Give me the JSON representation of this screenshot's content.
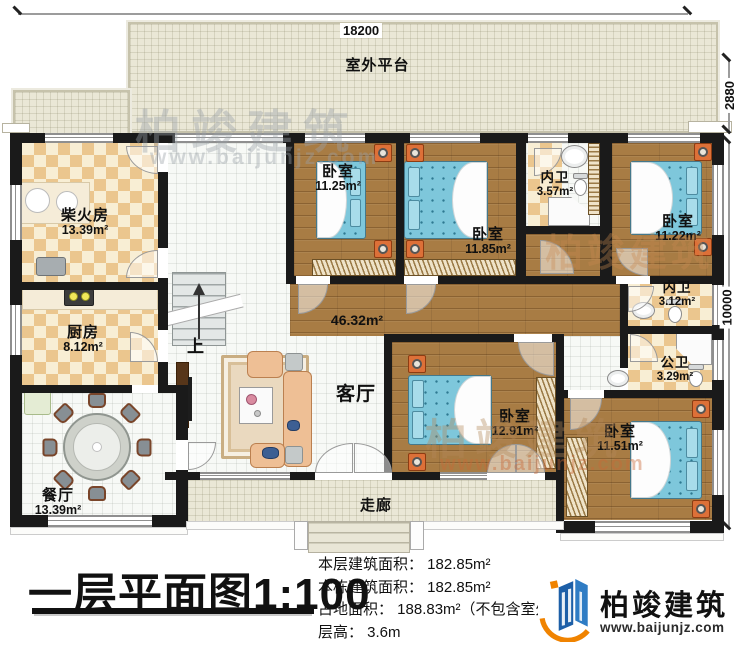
{
  "dimensions": {
    "top_width": "18200",
    "platform_depth": "2880",
    "side_depth": "10000"
  },
  "rooms": {
    "outdoor": {
      "name": "室外平台"
    },
    "chaihuofang": {
      "name": "柴火房",
      "area": "13.39m²"
    },
    "kitchen": {
      "name": "厨房",
      "area": "8.12m²"
    },
    "dining": {
      "name": "餐厅",
      "area": "13.39m²"
    },
    "living": {
      "name": "客厅",
      "area": "46.32m²"
    },
    "bedroom_a": {
      "name": "卧室",
      "area": "11.25m²"
    },
    "bedroom_b": {
      "name": "卧室",
      "area": "11.85m²"
    },
    "bedroom_c": {
      "name": "卧室",
      "area": "11.22m²"
    },
    "bedroom_d": {
      "name": "卧室",
      "area": "12.91m²"
    },
    "bedroom_e": {
      "name": "卧室",
      "area": "11.51m²"
    },
    "ensuite_a": {
      "name": "内卫",
      "area": "3.57m²"
    },
    "ensuite_b": {
      "name": "内卫",
      "area": "3.12m²"
    },
    "shared_bath": {
      "name": "公卫",
      "area": "3.29m²"
    },
    "corridor": {
      "name": "走廊"
    },
    "stairs_up": {
      "name": "上"
    }
  },
  "title": {
    "text": "一层平面图",
    "scale": "1:100"
  },
  "stats": {
    "lines": [
      "本层建筑面积： 182.85m²",
      "本栋建筑面积： 182.85m²",
      "占地面积： 188.83m²（不包含室外",
      "层高： 3.6m"
    ]
  },
  "brand": {
    "name": "柏竣建筑",
    "website": "www.baijunjz.com"
  },
  "watermark": {
    "name": "柏竣建筑",
    "website": "www.baijunjz.com"
  },
  "colors": {
    "wall": "#1a1a1a",
    "wood_floor": "#a87c44",
    "checker_tan": "#ebc68e",
    "bed_blue": "#7ec7db",
    "sofa_tan": "#eebf95",
    "platform": "#eae7d6",
    "brand_blue": "#1d5fa7",
    "brand_orange": "#f08300"
  }
}
